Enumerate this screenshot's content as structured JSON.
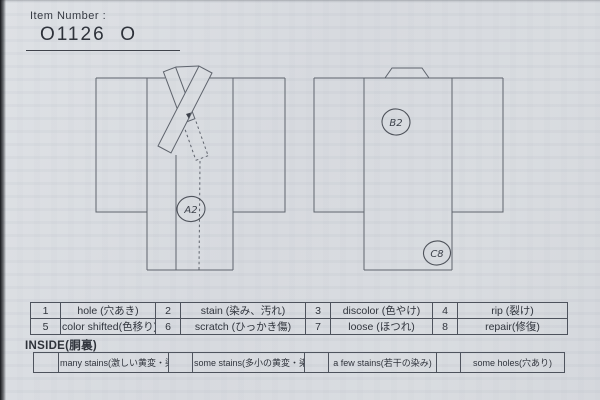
{
  "header": {
    "label": "Item Number :",
    "value": "O1126  O"
  },
  "annotations": {
    "front_body": "A2",
    "back_shoulder": "B2",
    "back_hem": "C8"
  },
  "condition_table": {
    "rows": [
      [
        {
          "num": "1",
          "label": "hole (穴あき)"
        },
        {
          "num": "2",
          "label": "stain (染み、汚れ)"
        },
        {
          "num": "3",
          "label": "discolor (色やけ)"
        },
        {
          "num": "4",
          "label": "rip (裂け)"
        }
      ],
      [
        {
          "num": "5",
          "label": "color shifted(色移り)"
        },
        {
          "num": "6",
          "label": "scratch (ひっかき傷)"
        },
        {
          "num": "7",
          "label": "loose (ほつれ)"
        },
        {
          "num": "8",
          "label": "repair(修復)"
        }
      ]
    ]
  },
  "inside": {
    "title": "INSIDE(胴裏)",
    "options": [
      "many stains(激しい黄変・染み)",
      "some stains(多小の黄変・染み)",
      "a few stains(若干の染み)",
      "some holes(穴あり)"
    ]
  },
  "colors": {
    "paper": "#d9dce1",
    "line": "#5e636c",
    "ink": "#2e323a"
  }
}
